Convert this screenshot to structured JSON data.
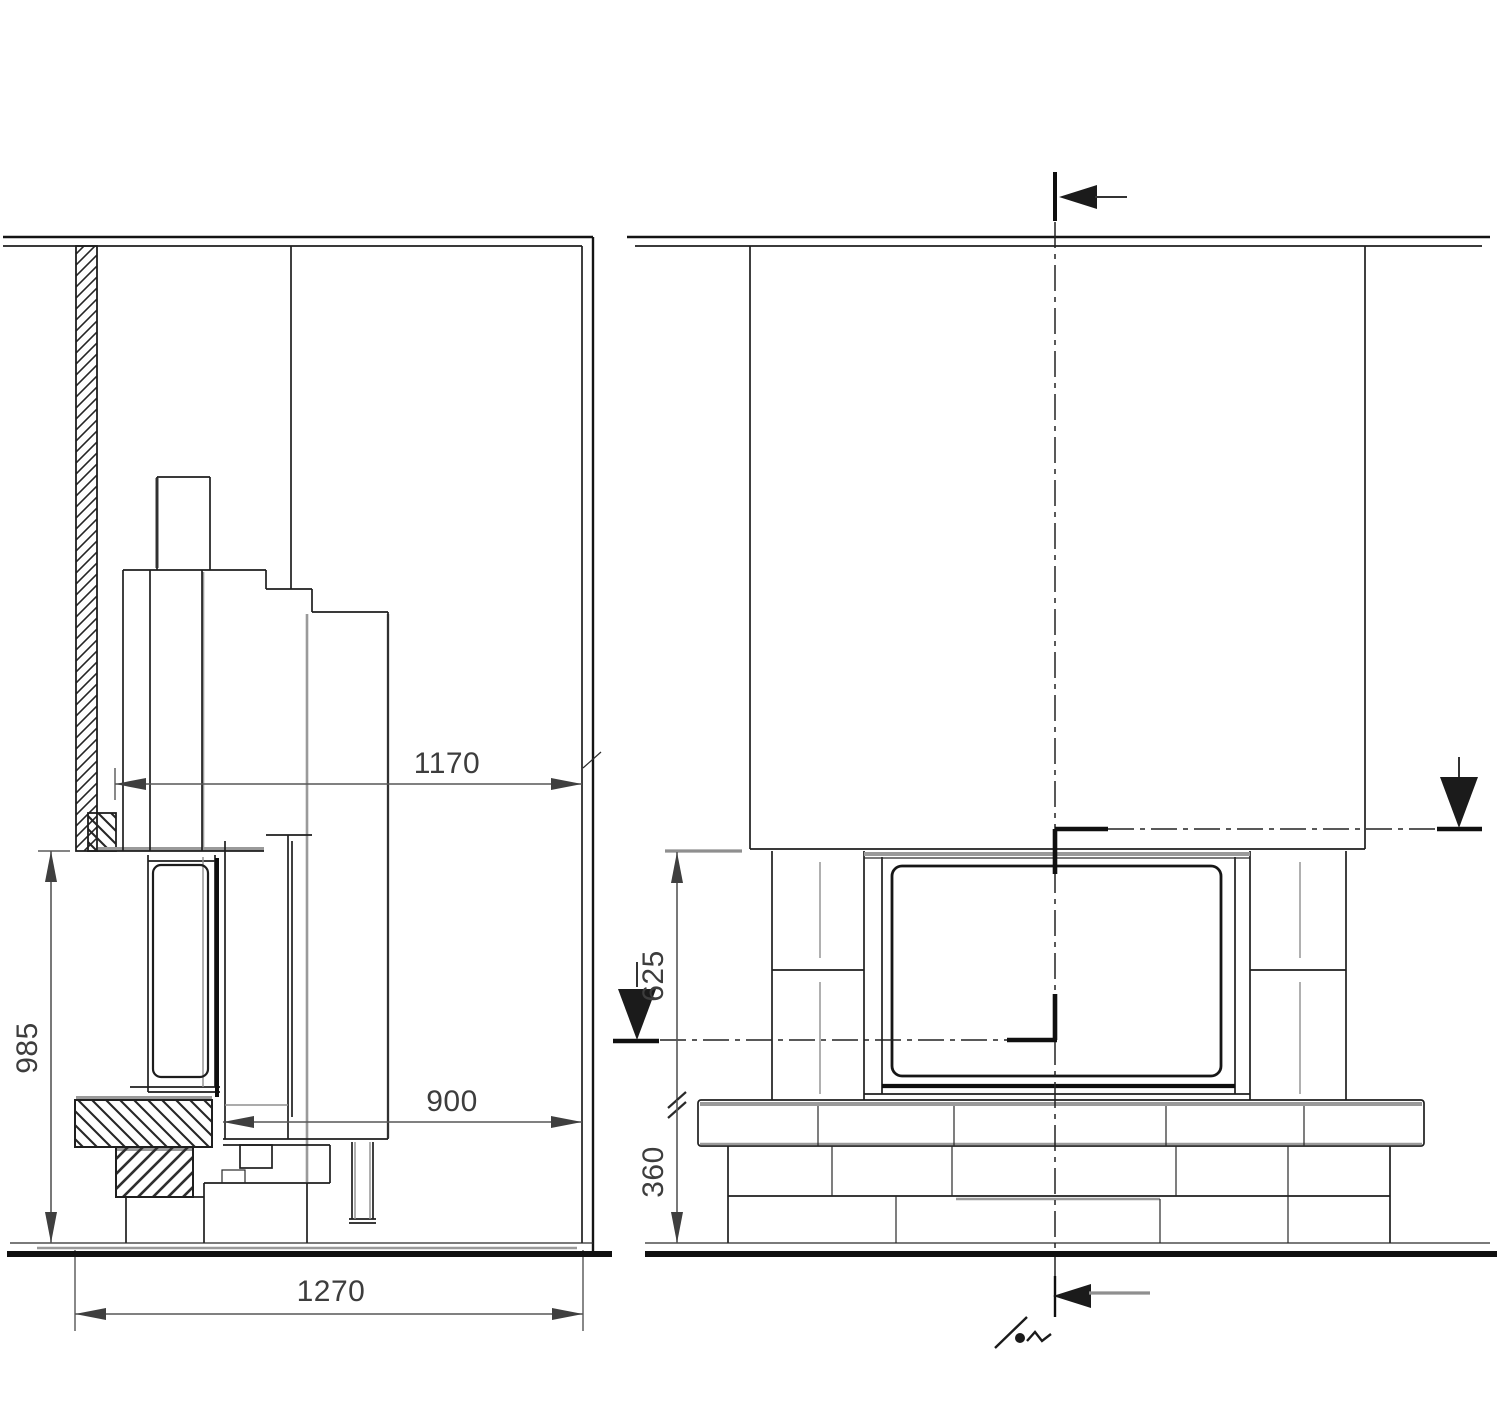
{
  "drawing": {
    "type": "fireplace installation sectional drawing",
    "background_color": "#ffffff",
    "ink_color": "#1f1f1f",
    "shadow_line_color": "#9a9a9a",
    "dimension_text_color": "#3d3d3d",
    "side_section": {
      "name": "side section view (left)",
      "dimensions": {
        "opening_depth": "1170",
        "front_clearance": "900",
        "overall_height": "985",
        "overall_depth": "1270"
      }
    },
    "front_section": {
      "name": "front section view (right)",
      "dimensions": {
        "opening_height": "625",
        "base_height": "360"
      }
    }
  }
}
